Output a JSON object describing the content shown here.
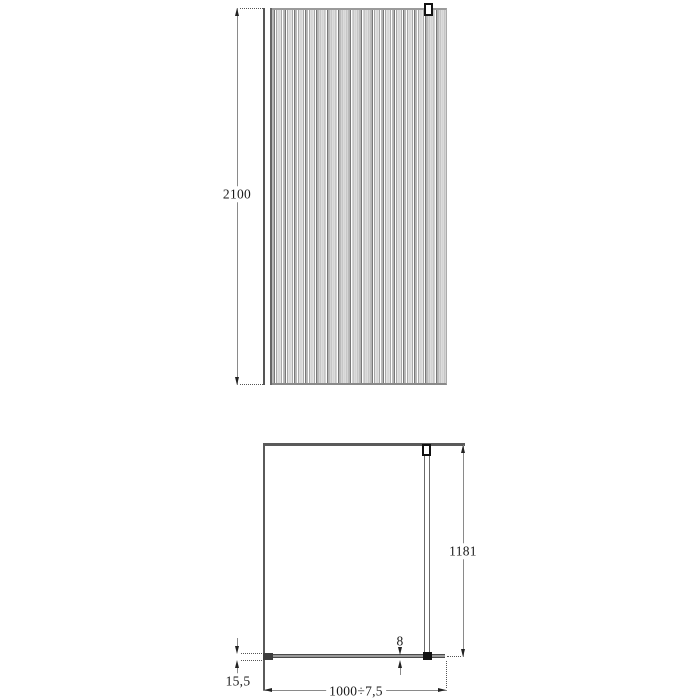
{
  "drawing": {
    "title": "walk-in-shower-screen-technical-drawing",
    "line_color": "#5a5a5a",
    "front_view": {
      "height_label": "2100"
    },
    "plan_view": {
      "depth_label": "1181",
      "glass_thickness_label": "8",
      "wall_profile_label": "15,5",
      "width_label": "1000÷7,5"
    }
  }
}
